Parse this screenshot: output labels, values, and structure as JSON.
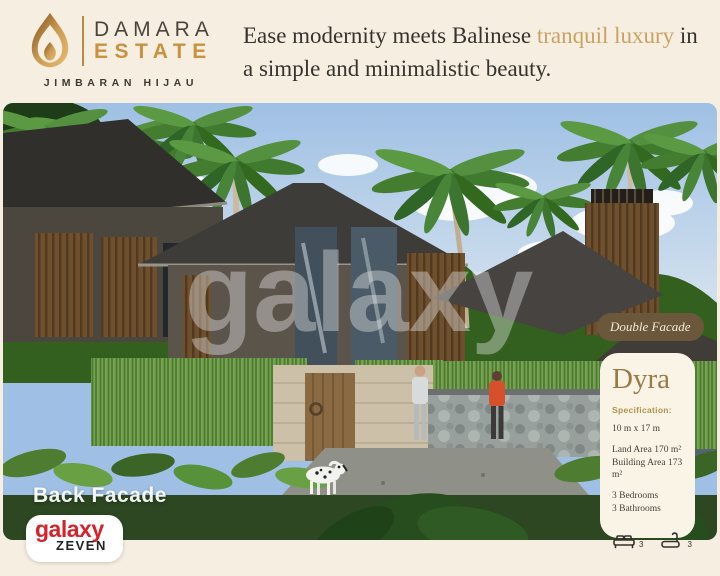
{
  "brand": {
    "line1": "DAMARA",
    "line2": "ESTATE",
    "subtitle": "JIMBARAN HIJAU"
  },
  "headline": {
    "part1": "Ease modernity meets Balinese ",
    "accent": "tranquil luxury",
    "part2": " in a simple and minimalistic beauty."
  },
  "photo": {
    "caption": "Back Facade",
    "watermark": "galaxy",
    "description": "Rendering of two-storey tropical villas with dark hipped roofs, wooden slat facades, palm trees, clipped hedges, stone wall with wooden door, two people walking a dalmatian dog"
  },
  "badge": {
    "label": "Double Facade"
  },
  "panel": {
    "title": "Dyra",
    "section_label": "Specification:",
    "dimensions": "10 m x 17 m",
    "land_area": "Land Area 170 m²",
    "building_area": "Building Area 173 m²",
    "bedrooms": "3 Bedrooms",
    "bathrooms": "3 Bathrooms",
    "bed_count": "3",
    "bath_count": "3"
  },
  "footer_logo": {
    "line1": "galaxy",
    "line2": "ZEVEN"
  },
  "colors": {
    "background": "#f6efe1",
    "headline_text": "#36332e",
    "headline_accent": "#c9a263",
    "estate_gold": "#c8923f",
    "badge_bg": "#6b583c",
    "panel_bg": "#f9f4e6",
    "panel_title_gold": "#9c7a45",
    "logo_red": "#d5232d"
  }
}
